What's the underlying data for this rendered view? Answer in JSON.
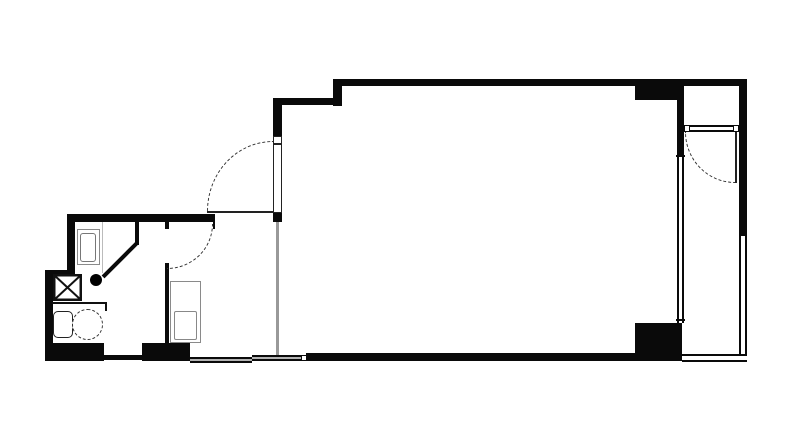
{
  "drawing": {
    "kind": "apartment-floor-plan",
    "colors": {
      "background": "#ffffff",
      "wall": "#0a0a0a",
      "partition": "#999999",
      "glass": "#b3b3b3",
      "fixture": "#8a8a8a",
      "arc": "#333333"
    },
    "symbols": [
      {
        "name": "entrance-door",
        "style": "quarter-arc-dashed"
      },
      {
        "name": "interior-door",
        "style": "quarter-arc-dashed"
      },
      {
        "name": "balcony-door",
        "style": "quarter-arc-dashed"
      },
      {
        "name": "bathroom-door",
        "style": "diagonal-leaf-with-knob-dot"
      },
      {
        "name": "shaft-x-box",
        "style": "rectangle-with-x"
      },
      {
        "name": "toilet",
        "style": "tank-and-bowl"
      },
      {
        "name": "wash-basin",
        "style": "nested-rectangles"
      },
      {
        "name": "kitchen-sink",
        "style": "counter-with-inset-sink"
      },
      {
        "name": "windows",
        "style": "double-line-with-gray-infill"
      },
      {
        "name": "structural-columns",
        "style": "solid-black-rectangles"
      }
    ]
  }
}
